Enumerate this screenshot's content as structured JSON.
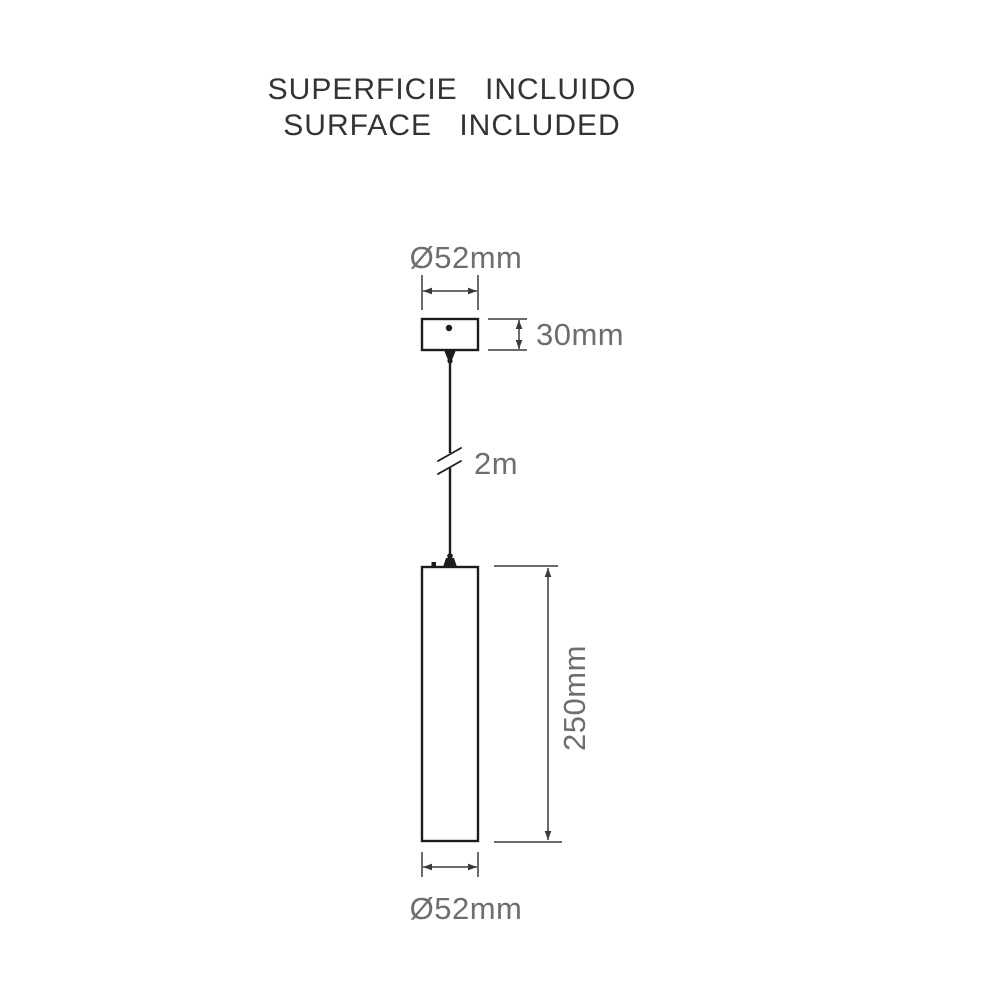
{
  "title": {
    "line1": "SUPERFICIE INCLUIDO",
    "line2": "SURFACE INCLUDED"
  },
  "labels": {
    "canopy_diameter": "Ø52mm",
    "canopy_height": "30mm",
    "cable_length": "2m",
    "body_height": "250mm",
    "body_diameter": "Ø52mm"
  },
  "colors": {
    "background": "#ffffff",
    "outline": "#1c1c1c",
    "dimension_line": "#3a3a3a",
    "label_text": "#6e6e6e",
    "title_text": "#333333"
  }
}
